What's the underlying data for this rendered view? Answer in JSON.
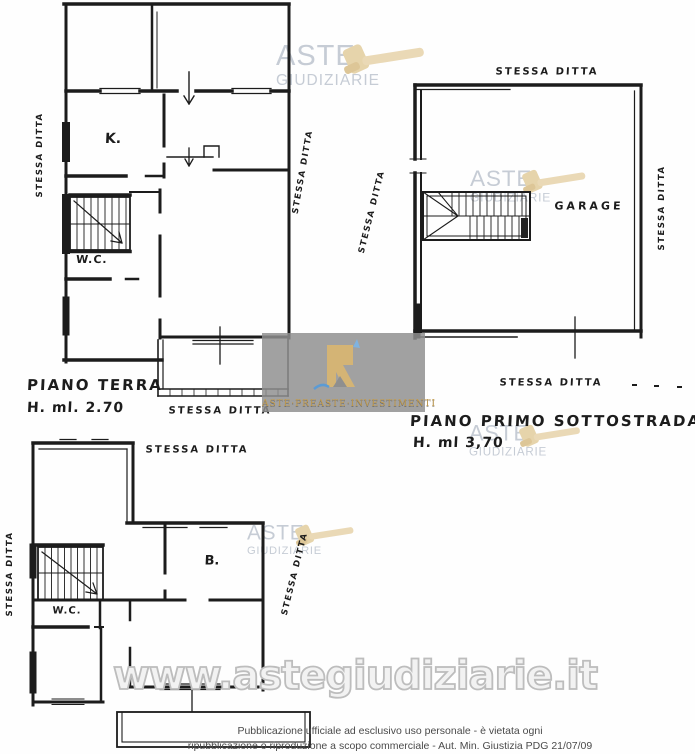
{
  "plan_piano_terra": {
    "title": "PIANO TERRA",
    "height_label": "H. ml. 2.70",
    "room_kitchen": "K.",
    "room_wc": "W.C.",
    "label_left": "STESSA DITTA",
    "label_right": "STESSA DITTA",
    "label_bottom": "STESSA DITTA"
  },
  "plan_piano_primo": {
    "title": "PIANO PRIMO SOTTOSTRADA",
    "height_label": "H. ml 3,70",
    "room_garage": "GARAGE",
    "label_top": "STESSA DITTA",
    "label_left": "STESSA DITTA",
    "label_right": "STESSA DITTA",
    "label_bottom": "STESSA DITTA"
  },
  "plan_lower": {
    "room_bath": "B.",
    "room_wc": "W.C.",
    "label_top": "STESSA DITTA",
    "label_left": "STESSA DITTA",
    "label_right": "STESSA DITTA"
  },
  "watermarks": {
    "logo_line1": "ASTE",
    "logo_line2": "GIUDIZIARIE",
    "logo_text_color": "#c6ccd5",
    "gavel_color": "#e6d4ab",
    "badge_text": "ASTE·PREASTE·INVESTIMENTI",
    "badge_bg": "#8f8f8f",
    "badge_gold": "#d4b475",
    "url_text": "www.astegiudiziarie.it",
    "disclaimer_line1": "Pubblicazione ufficiale ad esclusivo uso personale - è vietata ogni",
    "disclaimer_line2": "ripubblicazione o riproduzione a scopo commerciale - Aut. Min. Giustizia PDG 21/07/09"
  }
}
